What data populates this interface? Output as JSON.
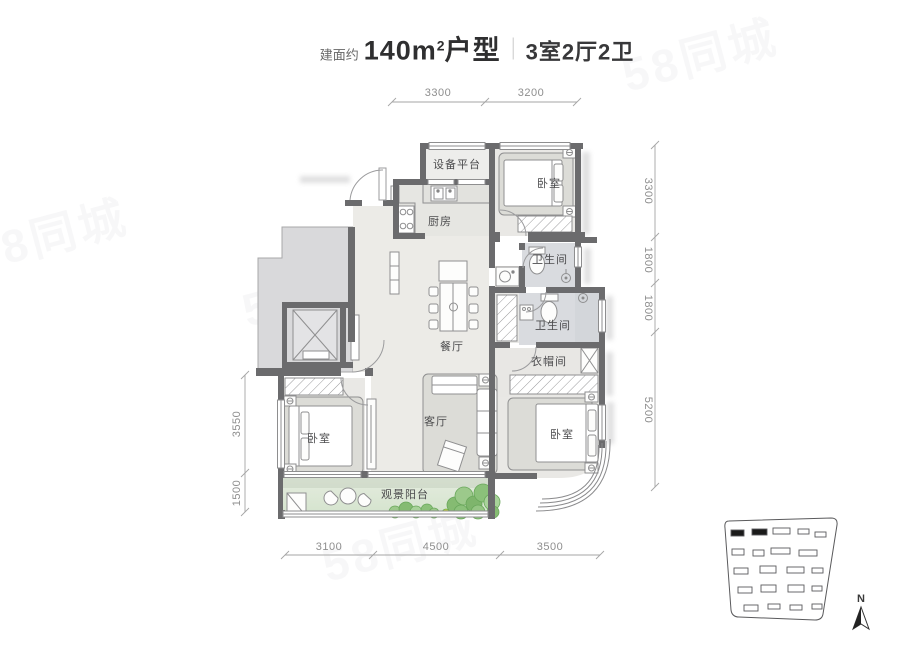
{
  "title": {
    "prefix": "建面约",
    "area_value": "140m",
    "area_exponent": "2",
    "type_suffix": "户型",
    "layout": "3室2厅2卫"
  },
  "rooms": {
    "equipment_platform": "设备平台",
    "bedroom_top": "卧室",
    "kitchen": "厨房",
    "bath_upper": "卫生间",
    "bath_lower": "卫生间",
    "dining": "餐厅",
    "cloakroom": "衣帽间",
    "living": "客厅",
    "bedroom_left": "卧室",
    "bedroom_right": "卧室",
    "balcony": "观景阳台"
  },
  "dimensions": {
    "top": [
      "3300",
      "3200"
    ],
    "right": [
      "3300",
      "1800",
      "1800",
      "5200"
    ],
    "left": [
      "3550",
      "1500"
    ],
    "bottom": [
      "3100",
      "4500",
      "3500"
    ]
  },
  "compass": {
    "north": "N"
  },
  "watermark": {
    "text": "58同城"
  },
  "colors": {
    "wall": "#6b6b6d",
    "floor": "#ecebe7",
    "bath_floor": "#d9dbdf",
    "corridor": "#d9d9db",
    "balcony_green": "#dce8d6",
    "plant_green": "#8bc17a"
  }
}
